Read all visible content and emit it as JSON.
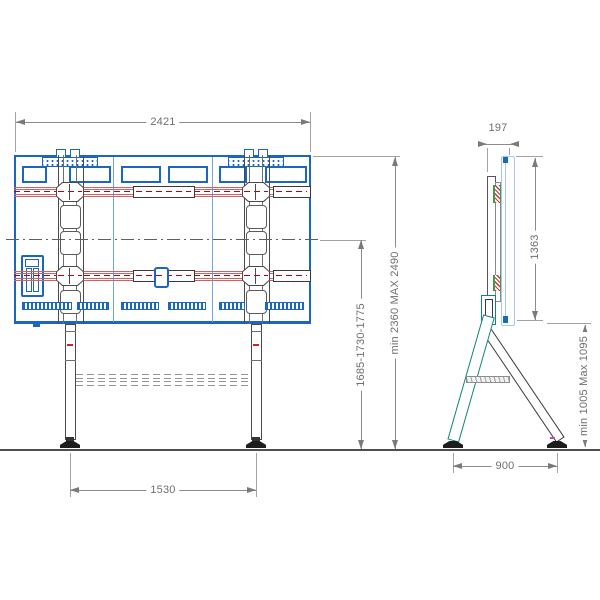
{
  "front_view": {
    "dims": {
      "width_top": "2421",
      "feet_span": "1530",
      "height_mid_range": "1685-1730-1775",
      "height_total_range": "min 2360 MAX 2490"
    }
  },
  "side_view": {
    "dims": {
      "depth_top": "197",
      "screen_height": "1363",
      "underside_height_range": "min 1005 Max 1095",
      "feet_span": "900"
    }
  },
  "colors": {
    "panel_blue": "#1a66c2",
    "pale_blue": "#a6c9ea",
    "rail_red": "#c00000",
    "stand_teal": "#0f8577",
    "dimension_gray": "#6f6f6f"
  }
}
